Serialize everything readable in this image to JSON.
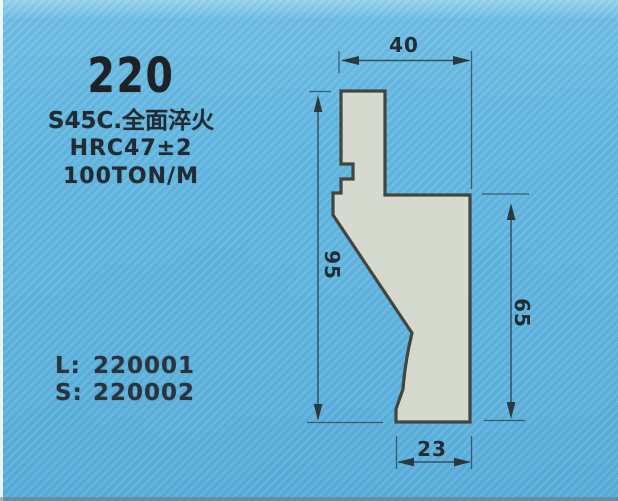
{
  "photo": {
    "model": "220",
    "spec_lines": [
      "S45C.全面淬火",
      "HRC47±2",
      "100TON/M"
    ],
    "codes": [
      {
        "label": "L:",
        "value": "220001"
      },
      {
        "label": "S:",
        "value": "220002"
      }
    ]
  },
  "drawing": {
    "type": "press-brake-punch-profile",
    "dimensions": {
      "top_width": "40",
      "overall_height": "95",
      "front_height": "65",
      "bottom_width": "23"
    }
  },
  "colors": {
    "background_blue": "#63b7e0",
    "profile_fill": "#d6d9ce",
    "profile_outline": "#41473f",
    "ink": "#242b32"
  }
}
